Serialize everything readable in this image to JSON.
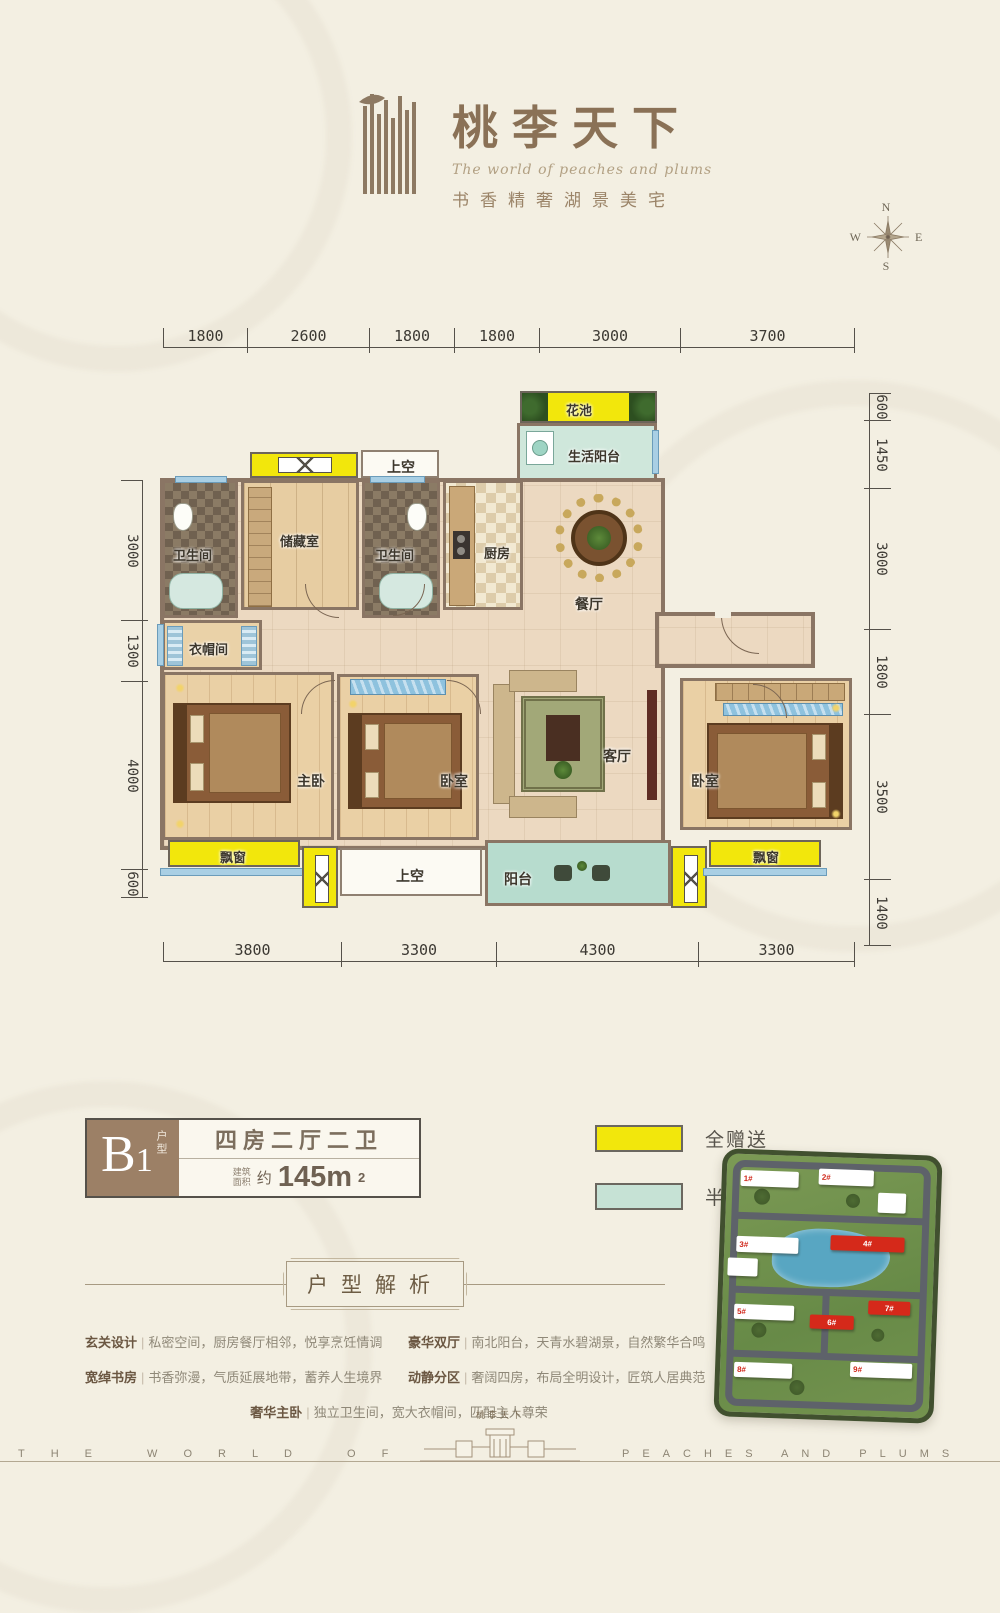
{
  "header": {
    "title": "桃李天下",
    "subtitle_en": "The world of peaches and plums",
    "tagline": "书香精奢湖景美宅"
  },
  "compass": {
    "n": "N",
    "e": "E",
    "s": "S",
    "w": "W"
  },
  "plan_dims": {
    "top": [
      "1800",
      "2600",
      "1800",
      "1800",
      "3000",
      "3700"
    ],
    "bottom": [
      "3800",
      "3300",
      "4300",
      "3300"
    ],
    "left": [
      "3000",
      "1300",
      "4000",
      "600"
    ],
    "right": [
      "600",
      "1450",
      "3000",
      "1800",
      "3500",
      "1400"
    ]
  },
  "rooms": {
    "flower_bed": "花池",
    "life_balcony": "生活阳台",
    "void_top": "上空",
    "bath1": "卫生间",
    "storage": "储藏室",
    "bath2": "卫生间",
    "kitchen": "厨房",
    "dining": "餐厅",
    "cloakroom": "衣帽间",
    "master": "主卧",
    "bedroom2": "卧室",
    "living": "客厅",
    "bedroom3": "卧室",
    "bay_left": "飘窗",
    "void_bottom": "上空",
    "balcony": "阳台",
    "bay_right": "飘窗"
  },
  "unit_card": {
    "unit_b": "B",
    "unit_1": "1",
    "unit_suffix": "户型",
    "layout": "四房二厅二卫",
    "area_label_1": "建筑",
    "area_label_2": "面积",
    "approx": "约",
    "area_value": "145m",
    "area_sup": "2"
  },
  "legend": {
    "full_gift": {
      "label": "全赠送",
      "color": "#f2e70c"
    },
    "half_gift": {
      "label": "半赠送",
      "color": "#c6e2d5"
    }
  },
  "colors": {
    "wall": "#8a7564",
    "gift_full": "#f2e70c",
    "gift_half": "#c6e2d5",
    "window": "#a9cfe4"
  },
  "analysis": {
    "title": "户型解析",
    "sep": "|",
    "items": [
      {
        "label": "玄关设计",
        "text": "私密空间，厨房餐厅相邻，悦享烹饪情调"
      },
      {
        "label": "豪华双厅",
        "text": "南北阳台，天青水碧湖景，自然繁华合鸣"
      },
      {
        "label": "宽绰书房",
        "text": "书香弥漫，气质延展地带，蓄养人生境界"
      },
      {
        "label": "动静分区",
        "text": "奢阔四房，布局全明设计，匠筑人居典范"
      },
      {
        "label": "奢华主卧",
        "text": "独立卫生间，宽大衣帽间，匹配主人尊荣"
      }
    ]
  },
  "sitemap": {
    "buildings": [
      "1#",
      "2#",
      "3#",
      "4#",
      "5#",
      "6#",
      "7#",
      "8#",
      "9#"
    ]
  },
  "footer": {
    "left": "THE WORLD OF",
    "right": "PEACHES AND PLUMS",
    "gate_title": "桃李天下"
  }
}
